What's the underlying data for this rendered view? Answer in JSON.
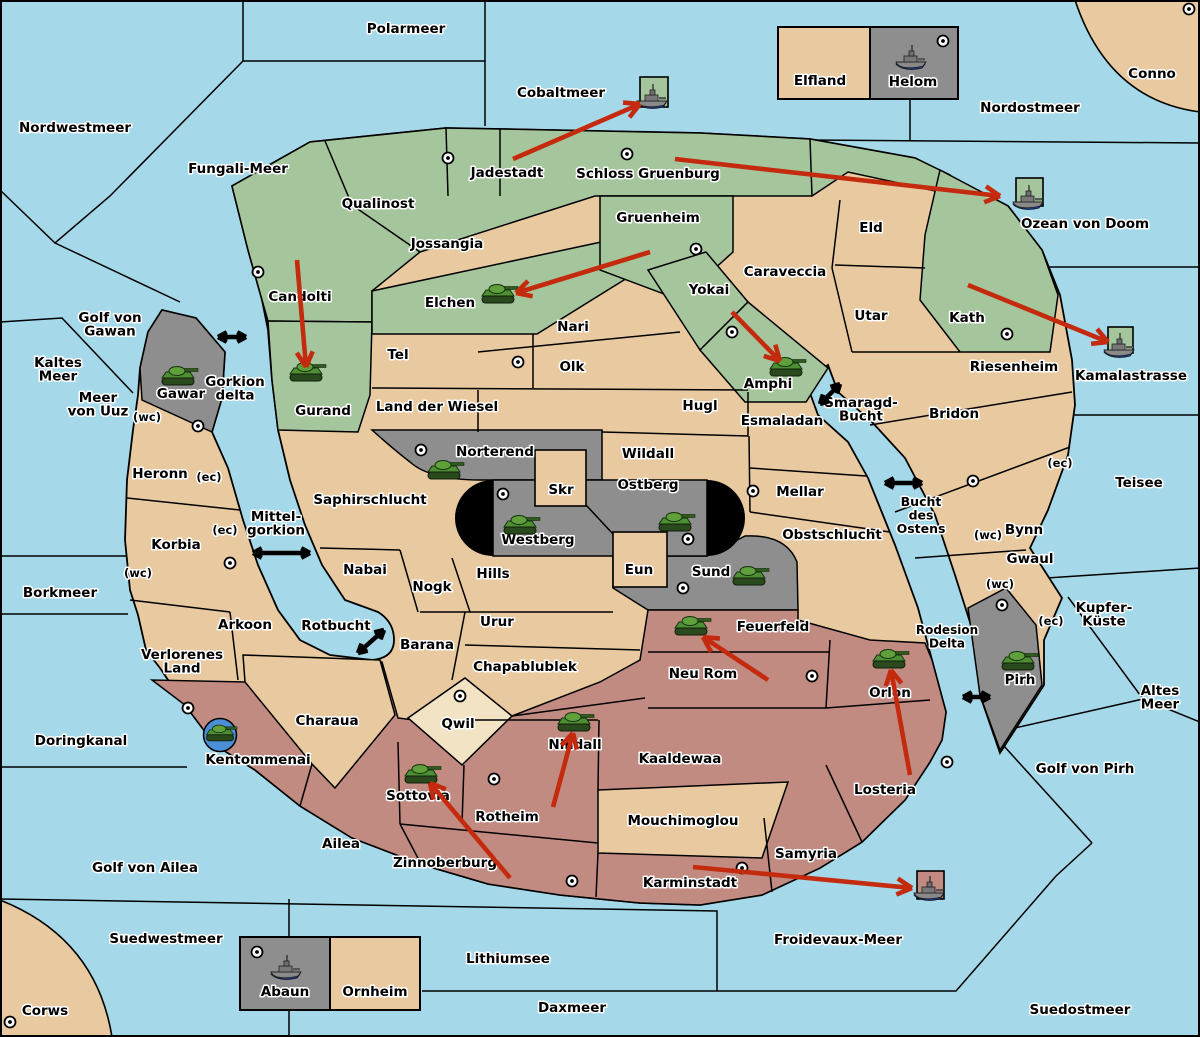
{
  "map": {
    "colors": {
      "sea": "#A5D8E8",
      "land": "#E9C9A0",
      "green": "#A5C69C",
      "gray": "#8E8E8E",
      "mauve": "#C18B82",
      "cream": "#F2E3C4",
      "black_zone": "#000000",
      "arrow_red": "#C42A0E",
      "arrow_black": "#000000",
      "unit_circle_blue": "#4B8FD6"
    },
    "sea_labels": [
      {
        "t": "Polarmeer",
        "x": 406,
        "y": 33
      },
      {
        "t": "Nordwestmeer",
        "x": 75,
        "y": 132
      },
      {
        "t": "Fungali-Meer",
        "x": 238,
        "y": 173
      },
      {
        "t": "Cobaltmeer",
        "x": 561,
        "y": 97
      },
      {
        "t": "Nordostmeer",
        "x": 1030,
        "y": 112
      },
      {
        "t": "Conno",
        "x": 1152,
        "y": 78
      },
      {
        "t": "Ozean von Doom",
        "x": 1085,
        "y": 228
      },
      {
        "t": "Kamalastrasse",
        "x": 1131,
        "y": 380
      },
      {
        "t": "Teisee",
        "x": 1139,
        "y": 487
      },
      {
        "lines": [
          "Kupfer-",
          "Küste"
        ],
        "x": 1104,
        "y": 612
      },
      {
        "lines": [
          "Altes",
          "Meer"
        ],
        "x": 1160,
        "y": 695
      },
      {
        "t": "Golf von Pirh",
        "x": 1085,
        "y": 773
      },
      {
        "lines": [
          "Golf von",
          "Gawan"
        ],
        "x": 110,
        "y": 322
      },
      {
        "lines": [
          "Kaltes",
          "Meer"
        ],
        "x": 58,
        "y": 367
      },
      {
        "lines": [
          "Meer",
          "von Uuz"
        ],
        "x": 98,
        "y": 402
      },
      {
        "lines": [
          "Gorkion",
          "delta"
        ],
        "x": 235,
        "y": 386
      },
      {
        "lines": [
          "Mittel-",
          "gorkion"
        ],
        "x": 276,
        "y": 521
      },
      {
        "lines": [
          "Smaragd-",
          "Bucht"
        ],
        "x": 861,
        "y": 407
      },
      {
        "lines": [
          "Bucht",
          "des",
          "Ostens"
        ],
        "x": 921,
        "y": 506,
        "fs": 12.5
      },
      {
        "lines": [
          "Rodesion",
          "Delta"
        ],
        "x": 947,
        "y": 634,
        "fs": 12
      },
      {
        "t": "Rotbucht",
        "x": 336,
        "y": 630
      },
      {
        "t": "Borkmeer",
        "x": 60,
        "y": 597
      },
      {
        "t": "Doringkanal",
        "x": 81,
        "y": 745
      },
      {
        "t": "Golf von Ailea",
        "x": 145,
        "y": 872
      },
      {
        "t": "Suedwestmeer",
        "x": 166,
        "y": 943
      },
      {
        "t": "Corws",
        "x": 45,
        "y": 1015
      },
      {
        "t": "Lithiumsee",
        "x": 508,
        "y": 963
      },
      {
        "t": "Daxmeer",
        "x": 572,
        "y": 1012
      },
      {
        "t": "Froidevaux-Meer",
        "x": 838,
        "y": 944
      },
      {
        "t": "Suedostmeer",
        "x": 1080,
        "y": 1014
      }
    ],
    "territory_labels": [
      {
        "t": "Qualinost",
        "x": 378,
        "y": 208
      },
      {
        "t": "Candolti",
        "x": 300,
        "y": 301
      },
      {
        "t": "Jadestadt",
        "x": 507,
        "y": 177
      },
      {
        "t": "Schloss Gruenburg",
        "x": 648,
        "y": 178
      },
      {
        "t": "Jossangia",
        "x": 447,
        "y": 248
      },
      {
        "t": "Gruenheim",
        "x": 658,
        "y": 222
      },
      {
        "t": "Caraveccia",
        "x": 785,
        "y": 276
      },
      {
        "t": "Yokai",
        "x": 709,
        "y": 294
      },
      {
        "t": "Eld",
        "x": 871,
        "y": 232
      },
      {
        "t": "Utar",
        "x": 871,
        "y": 320
      },
      {
        "t": "Kath",
        "x": 967,
        "y": 322
      },
      {
        "t": "Elchen",
        "x": 450,
        "y": 307
      },
      {
        "t": "Nari",
        "x": 573,
        "y": 331
      },
      {
        "t": "Olk",
        "x": 572,
        "y": 371
      },
      {
        "t": "Tel",
        "x": 398,
        "y": 359
      },
      {
        "t": "Land der Wiesel",
        "x": 437,
        "y": 411
      },
      {
        "t": "Hugl",
        "x": 700,
        "y": 410
      },
      {
        "t": "Esmaladan",
        "x": 782,
        "y": 425
      },
      {
        "t": "Gurand",
        "x": 323,
        "y": 415
      },
      {
        "t": "Gawar",
        "x": 181,
        "y": 398
      },
      {
        "t": "Amphi",
        "x": 768,
        "y": 388
      },
      {
        "t": "Riesenheim",
        "x": 1014,
        "y": 371
      },
      {
        "t": "Bridon",
        "x": 954,
        "y": 418
      },
      {
        "t": "Bynn",
        "x": 1024,
        "y": 534
      },
      {
        "t": "Gwaul",
        "x": 1030,
        "y": 563
      },
      {
        "t": "Mellar",
        "x": 800,
        "y": 496
      },
      {
        "t": "Obstschlucht",
        "x": 832,
        "y": 539
      },
      {
        "t": "Norterend",
        "x": 495,
        "y": 456
      },
      {
        "t": "Wildall",
        "x": 648,
        "y": 458
      },
      {
        "t": "Skr",
        "x": 561,
        "y": 494
      },
      {
        "t": "Ostberg",
        "x": 648,
        "y": 489
      },
      {
        "t": "Westberg",
        "x": 538,
        "y": 544
      },
      {
        "t": "Eun",
        "x": 639,
        "y": 574
      },
      {
        "t": "Sund",
        "x": 711,
        "y": 576
      },
      {
        "t": "Hills",
        "x": 493,
        "y": 578
      },
      {
        "t": "Nogk",
        "x": 432,
        "y": 591
      },
      {
        "t": "Nabai",
        "x": 365,
        "y": 574
      },
      {
        "t": "Saphirschlucht",
        "x": 370,
        "y": 504
      },
      {
        "t": "Heronn",
        "x": 160,
        "y": 478
      },
      {
        "t": "Korbia",
        "x": 176,
        "y": 549
      },
      {
        "t": "Arkoon",
        "x": 245,
        "y": 629
      },
      {
        "lines": [
          "Verlorenes",
          "Land"
        ],
        "x": 182,
        "y": 659
      },
      {
        "t": "Charaua",
        "x": 327,
        "y": 725
      },
      {
        "t": "Kentommenai",
        "x": 258,
        "y": 764
      },
      {
        "t": "Ailea",
        "x": 341,
        "y": 848
      },
      {
        "t": "Zinnoberburg",
        "x": 445,
        "y": 867
      },
      {
        "t": "Sottovia",
        "x": 418,
        "y": 800
      },
      {
        "t": "Rotheim",
        "x": 507,
        "y": 821
      },
      {
        "t": "Qwil",
        "x": 458,
        "y": 728
      },
      {
        "t": "Chapablublek",
        "x": 525,
        "y": 671
      },
      {
        "t": "Urur",
        "x": 497,
        "y": 626
      },
      {
        "t": "Barana",
        "x": 427,
        "y": 649
      },
      {
        "t": "Nilldall",
        "x": 575,
        "y": 749
      },
      {
        "t": "Kaaldewaa",
        "x": 680,
        "y": 763
      },
      {
        "t": "Mouchimoglou",
        "x": 683,
        "y": 825
      },
      {
        "t": "Neu Rom",
        "x": 703,
        "y": 678
      },
      {
        "t": "Feuerfeld",
        "x": 773,
        "y": 631
      },
      {
        "t": "Orlon",
        "x": 890,
        "y": 697
      },
      {
        "t": "Losteria",
        "x": 885,
        "y": 794
      },
      {
        "t": "Samyria",
        "x": 806,
        "y": 858
      },
      {
        "t": "Karminstadt",
        "x": 690,
        "y": 887
      },
      {
        "t": "Pirh",
        "x": 1020,
        "y": 684
      },
      {
        "t": "Elfland",
        "x": 820,
        "y": 85
      },
      {
        "t": "Helom",
        "x": 913,
        "y": 86
      },
      {
        "t": "Abaun",
        "x": 285,
        "y": 996
      },
      {
        "t": "Ornheim",
        "x": 375,
        "y": 996
      }
    ],
    "coast_tags": [
      {
        "t": "(wc)",
        "x": 147,
        "y": 421
      },
      {
        "t": "(ec)",
        "x": 209,
        "y": 481
      },
      {
        "t": "(ec)",
        "x": 225,
        "y": 534
      },
      {
        "t": "(wc)",
        "x": 138,
        "y": 577
      },
      {
        "t": "(wc)",
        "x": 988,
        "y": 539
      },
      {
        "t": "(ec)",
        "x": 1060,
        "y": 467
      },
      {
        "t": "(wc)",
        "x": 1000,
        "y": 588
      },
      {
        "t": "(ec)",
        "x": 1051,
        "y": 625
      }
    ],
    "supply_centers": [
      {
        "x": 258,
        "y": 272
      },
      {
        "x": 448,
        "y": 158
      },
      {
        "x": 627,
        "y": 154
      },
      {
        "x": 696,
        "y": 249
      },
      {
        "x": 1189,
        "y": 9
      },
      {
        "x": 943,
        "y": 41
      },
      {
        "x": 732,
        "y": 332
      },
      {
        "x": 518,
        "y": 362
      },
      {
        "x": 198,
        "y": 426
      },
      {
        "x": 421,
        "y": 450
      },
      {
        "x": 503,
        "y": 494
      },
      {
        "x": 688,
        "y": 539
      },
      {
        "x": 753,
        "y": 491
      },
      {
        "x": 683,
        "y": 588
      },
      {
        "x": 230,
        "y": 563
      },
      {
        "x": 188,
        "y": 708
      },
      {
        "x": 460,
        "y": 696
      },
      {
        "x": 494,
        "y": 779
      },
      {
        "x": 572,
        "y": 881
      },
      {
        "x": 742,
        "y": 868
      },
      {
        "x": 812,
        "y": 676
      },
      {
        "x": 947,
        "y": 762
      },
      {
        "x": 1002,
        "y": 605
      },
      {
        "x": 973,
        "y": 481
      },
      {
        "x": 1007,
        "y": 334
      },
      {
        "x": 10,
        "y": 1022
      },
      {
        "x": 257,
        "y": 952
      }
    ],
    "armies": [
      {
        "territory": "Gawar",
        "x": 178,
        "y": 377
      },
      {
        "territory": "Gurand",
        "x": 306,
        "y": 373
      },
      {
        "territory": "Elchen",
        "x": 498,
        "y": 295
      },
      {
        "territory": "Amphi",
        "x": 786,
        "y": 368
      },
      {
        "territory": "Norterend",
        "x": 444,
        "y": 471
      },
      {
        "territory": "Westberg",
        "x": 520,
        "y": 526
      },
      {
        "territory": "Ostberg",
        "x": 675,
        "y": 523
      },
      {
        "territory": "Sund",
        "x": 749,
        "y": 577
      },
      {
        "territory": "Feuerfeld",
        "x": 691,
        "y": 627
      },
      {
        "territory": "Nilldall",
        "x": 574,
        "y": 723
      },
      {
        "territory": "Sottovia",
        "x": 421,
        "y": 775
      },
      {
        "territory": "Orlon",
        "x": 889,
        "y": 660
      },
      {
        "territory": "Pirh",
        "x": 1018,
        "y": 662
      },
      {
        "territory": "Kentommenai",
        "x": 220,
        "y": 734,
        "circled": true
      }
    ],
    "fleets": [
      {
        "sea": "Cobaltmeer",
        "x": 652,
        "y": 99,
        "box": {
          "x": 640,
          "y": 77,
          "w": 28,
          "h": 30,
          "c": "#A5C69C"
        }
      },
      {
        "sea": "Ozean von Doom",
        "x": 1028,
        "y": 200,
        "box": {
          "x": 1016,
          "y": 178,
          "w": 27,
          "h": 28,
          "c": "#A5C69C"
        }
      },
      {
        "sea": "Kamalastrasse",
        "x": 1119,
        "y": 348,
        "box": {
          "x": 1108,
          "y": 327,
          "w": 25,
          "h": 26,
          "c": "#A5C69C"
        }
      },
      {
        "sea": "Helom",
        "x": 911,
        "y": 60
      },
      {
        "sea": "Abaun",
        "x": 286,
        "y": 970
      },
      {
        "sea": "Froidevaux-Meer",
        "x": 929,
        "y": 891,
        "box": {
          "x": 917,
          "y": 871,
          "w": 27,
          "h": 28,
          "c": "#C18B82"
        }
      }
    ],
    "move_arrows": [
      {
        "x1": 513,
        "y1": 159,
        "x2": 640,
        "y2": 104
      },
      {
        "x1": 675,
        "y1": 159,
        "x2": 1000,
        "y2": 196
      },
      {
        "x1": 650,
        "y1": 252,
        "x2": 516,
        "y2": 293
      },
      {
        "x1": 297,
        "y1": 260,
        "x2": 306,
        "y2": 367
      },
      {
        "x1": 732,
        "y1": 312,
        "x2": 780,
        "y2": 361
      },
      {
        "x1": 968,
        "y1": 285,
        "x2": 1108,
        "y2": 342
      },
      {
        "x1": 768,
        "y1": 680,
        "x2": 703,
        "y2": 637
      },
      {
        "x1": 553,
        "y1": 807,
        "x2": 573,
        "y2": 733
      },
      {
        "x1": 510,
        "y1": 878,
        "x2": 430,
        "y2": 783
      },
      {
        "x1": 910,
        "y1": 775,
        "x2": 891,
        "y2": 670
      },
      {
        "x1": 693,
        "y1": 867,
        "x2": 912,
        "y2": 888
      }
    ],
    "strait_arrows": [
      {
        "x1": 218,
        "y1": 337,
        "x2": 246,
        "y2": 337
      },
      {
        "x1": 253,
        "y1": 553,
        "x2": 310,
        "y2": 553
      },
      {
        "x1": 820,
        "y1": 404,
        "x2": 840,
        "y2": 384
      },
      {
        "x1": 885,
        "y1": 483,
        "x2": 922,
        "y2": 483
      },
      {
        "x1": 358,
        "y1": 653,
        "x2": 384,
        "y2": 630
      },
      {
        "x1": 963,
        "y1": 697,
        "x2": 990,
        "y2": 697
      }
    ]
  }
}
